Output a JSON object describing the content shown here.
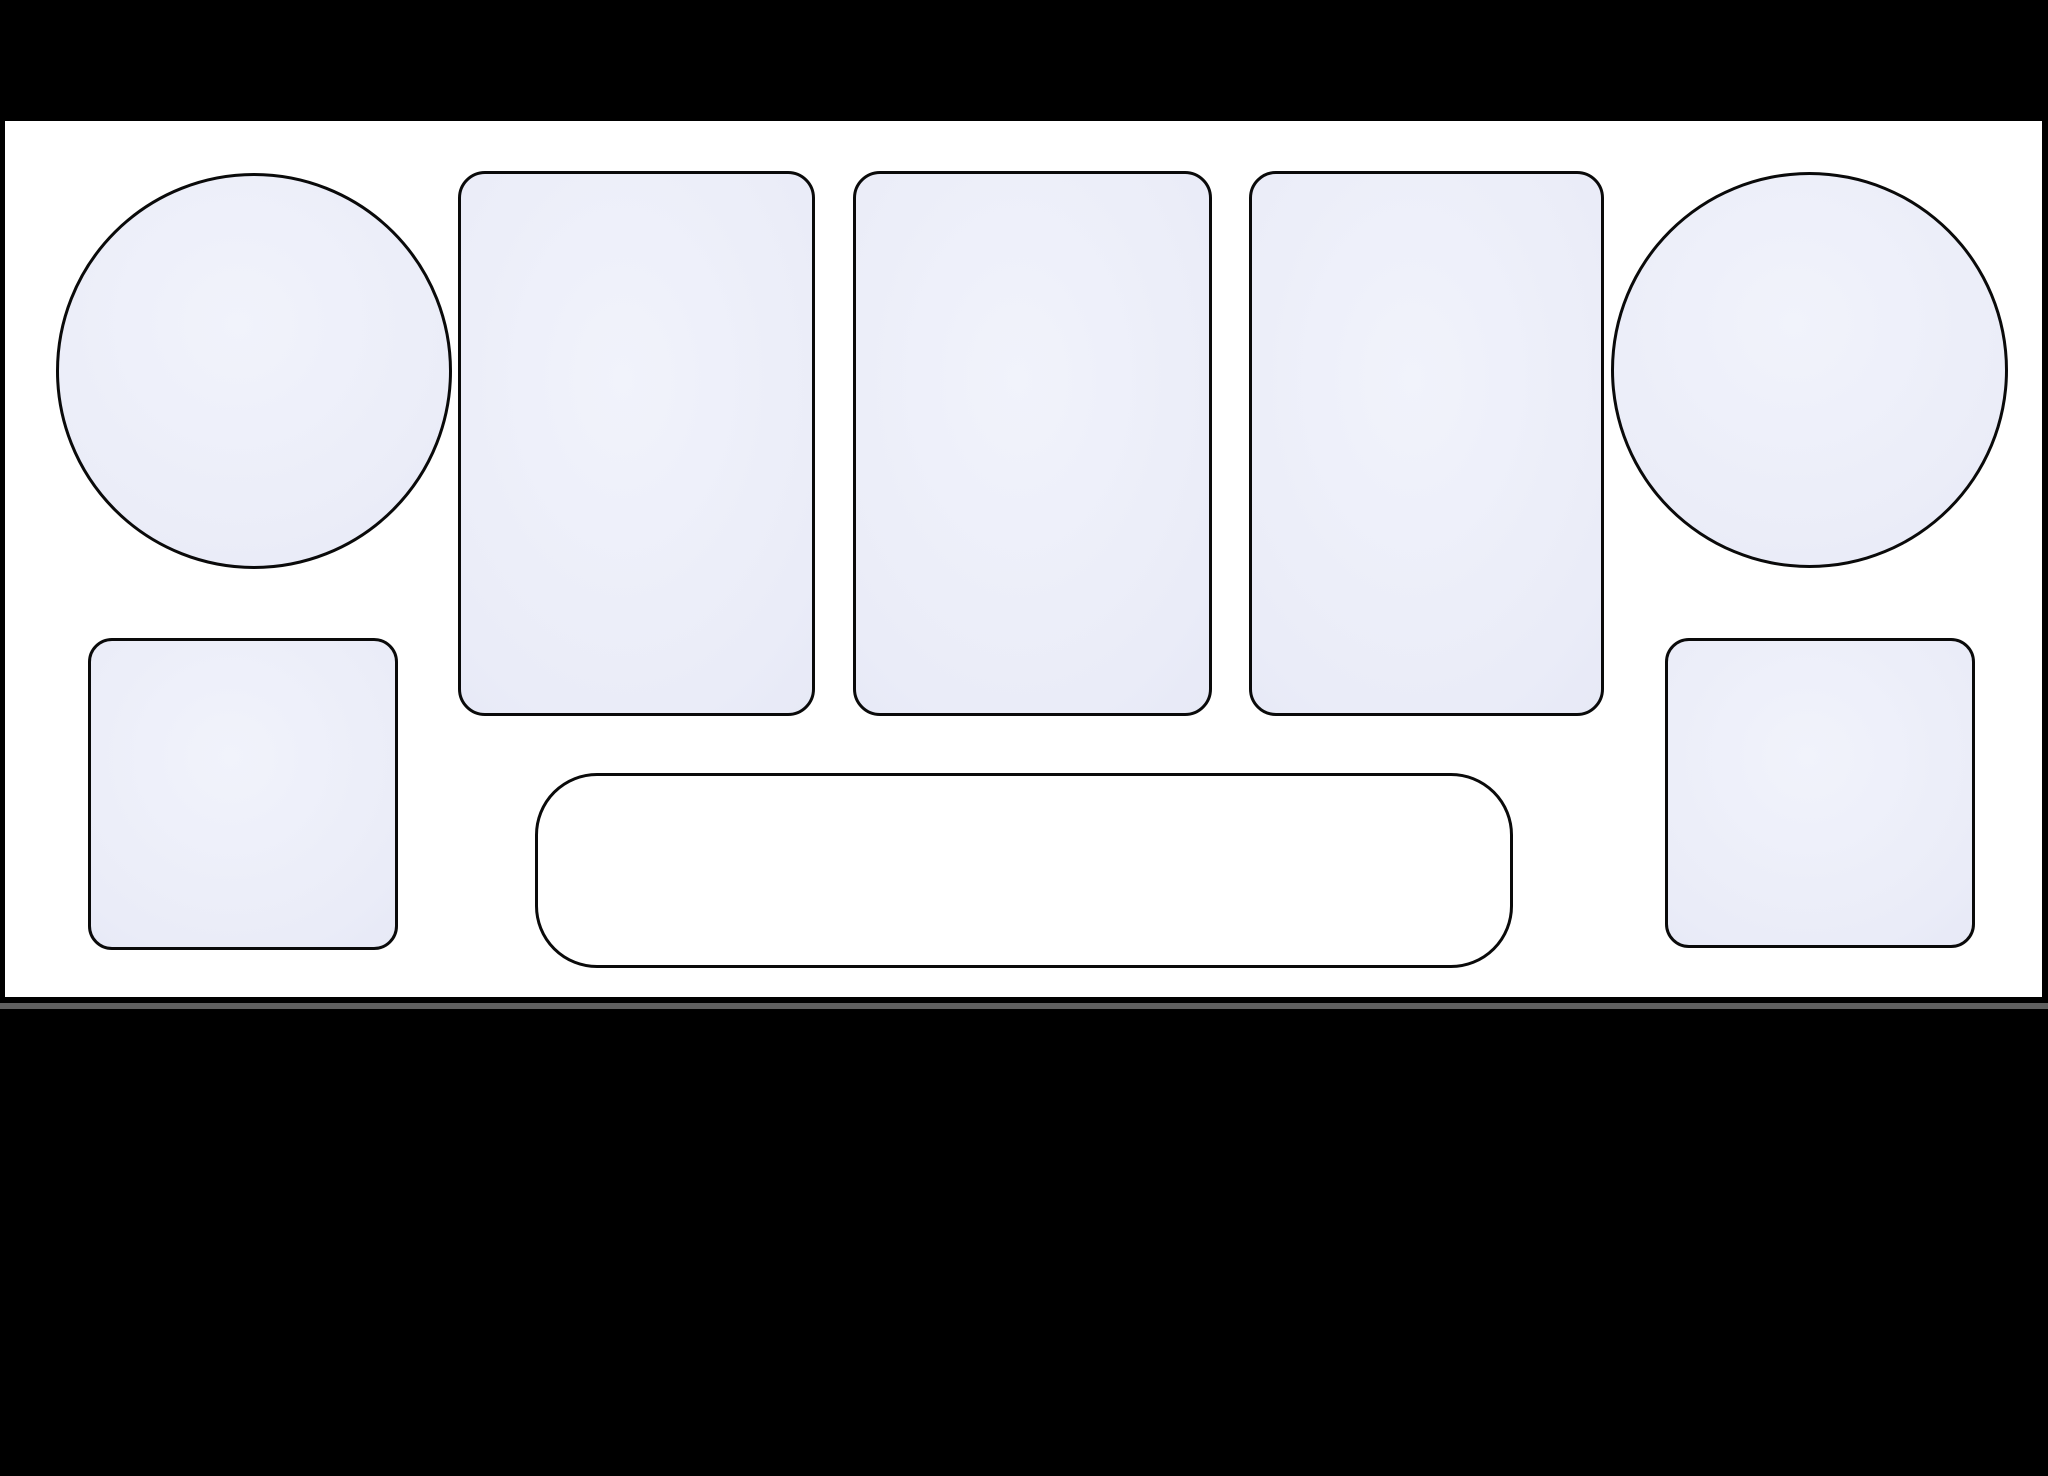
{
  "canvas": {
    "width": 2048,
    "height": 1476,
    "background_color": "#000000"
  },
  "panel": {
    "x": 5,
    "y": 121,
    "width": 2037,
    "height": 876,
    "fill_color": "#ffffff"
  },
  "divider_line": {
    "x": 0,
    "y": 1003,
    "width": 2048,
    "height": 6,
    "color": "#606060"
  },
  "shape_style": {
    "stroke_color": "#0a0a0a",
    "stroke_width": 3,
    "zone_fill_light": "#f1f3fb",
    "zone_fill_mid": "#eaecf8",
    "zone_fill_edge": "#e1e4f3",
    "tray_fill": "#ffffff"
  },
  "shapes": [
    {
      "id": "left-circle-zone",
      "role": "circular zone",
      "type": "circle",
      "x": 56,
      "y": 173,
      "width": 396,
      "height": 396,
      "fill": "zone"
    },
    {
      "id": "card-slot-1",
      "role": "card slot",
      "type": "rounded-rect",
      "x": 458,
      "y": 171,
      "width": 357,
      "height": 545,
      "radius": 27,
      "fill": "zone"
    },
    {
      "id": "card-slot-2",
      "role": "card slot",
      "type": "rounded-rect",
      "x": 853,
      "y": 171,
      "width": 359,
      "height": 545,
      "radius": 27,
      "fill": "zone"
    },
    {
      "id": "card-slot-3",
      "role": "card slot",
      "type": "rounded-rect",
      "x": 1249,
      "y": 171,
      "width": 355,
      "height": 545,
      "radius": 27,
      "fill": "zone"
    },
    {
      "id": "right-circle-zone",
      "role": "circular zone",
      "type": "circle",
      "x": 1611,
      "y": 172,
      "width": 397,
      "height": 396,
      "fill": "zone"
    },
    {
      "id": "left-square-zone",
      "role": "square zone",
      "type": "rounded-rect",
      "x": 88,
      "y": 638,
      "width": 310,
      "height": 312,
      "radius": 24,
      "fill": "zone"
    },
    {
      "id": "bottom-tray",
      "role": "wide tray zone",
      "type": "rounded-rect",
      "x": 535,
      "y": 773,
      "width": 978,
      "height": 195,
      "radius": 62,
      "fill": "tray"
    },
    {
      "id": "right-square-zone",
      "role": "square zone",
      "type": "rounded-rect",
      "x": 1665,
      "y": 638,
      "width": 310,
      "height": 310,
      "radius": 24,
      "fill": "zone"
    }
  ]
}
